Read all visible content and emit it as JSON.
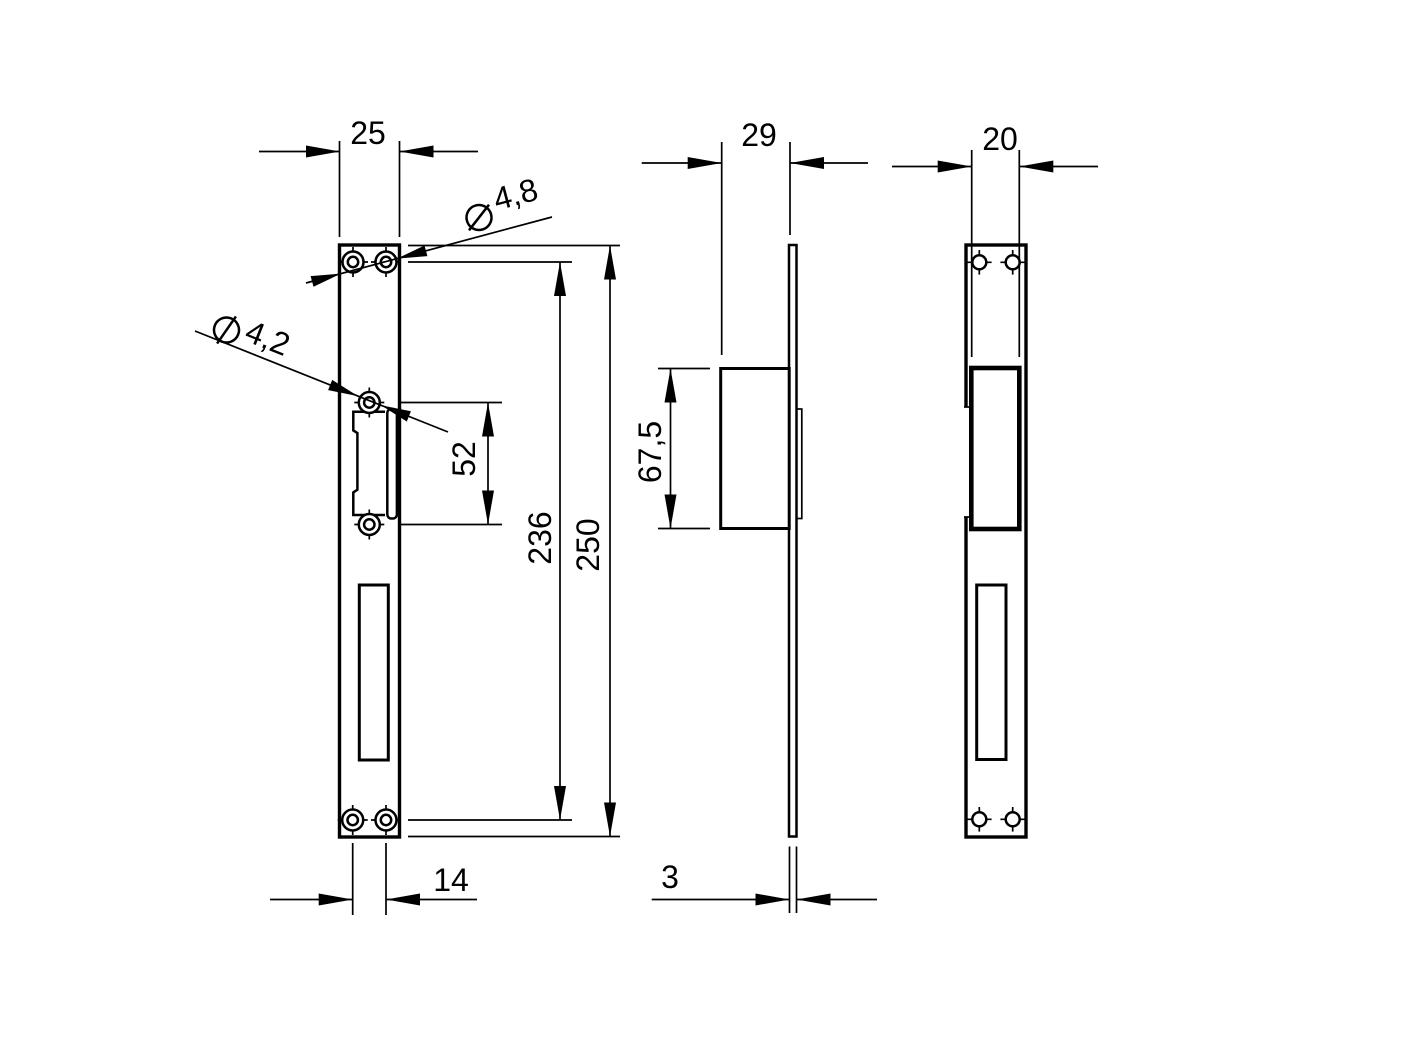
{
  "drawing": {
    "background_color": "#ffffff",
    "line_color": "#000000",
    "views": {
      "front_view": {
        "plate_width": "25",
        "bottom_hole_spacing": "14",
        "top_holes_diameter": "4,8",
        "middle_holes_diameter": "4,2",
        "middle_holes_span": "52",
        "corner_holes_span": "236",
        "plate_height": "250",
        "diameter_symbol": "⌀"
      },
      "side_view": {
        "overall_depth": "29",
        "keeper_box_height": "67,5",
        "plate_thickness": "3"
      },
      "back_view": {
        "keeper_box_width": "20"
      }
    }
  }
}
